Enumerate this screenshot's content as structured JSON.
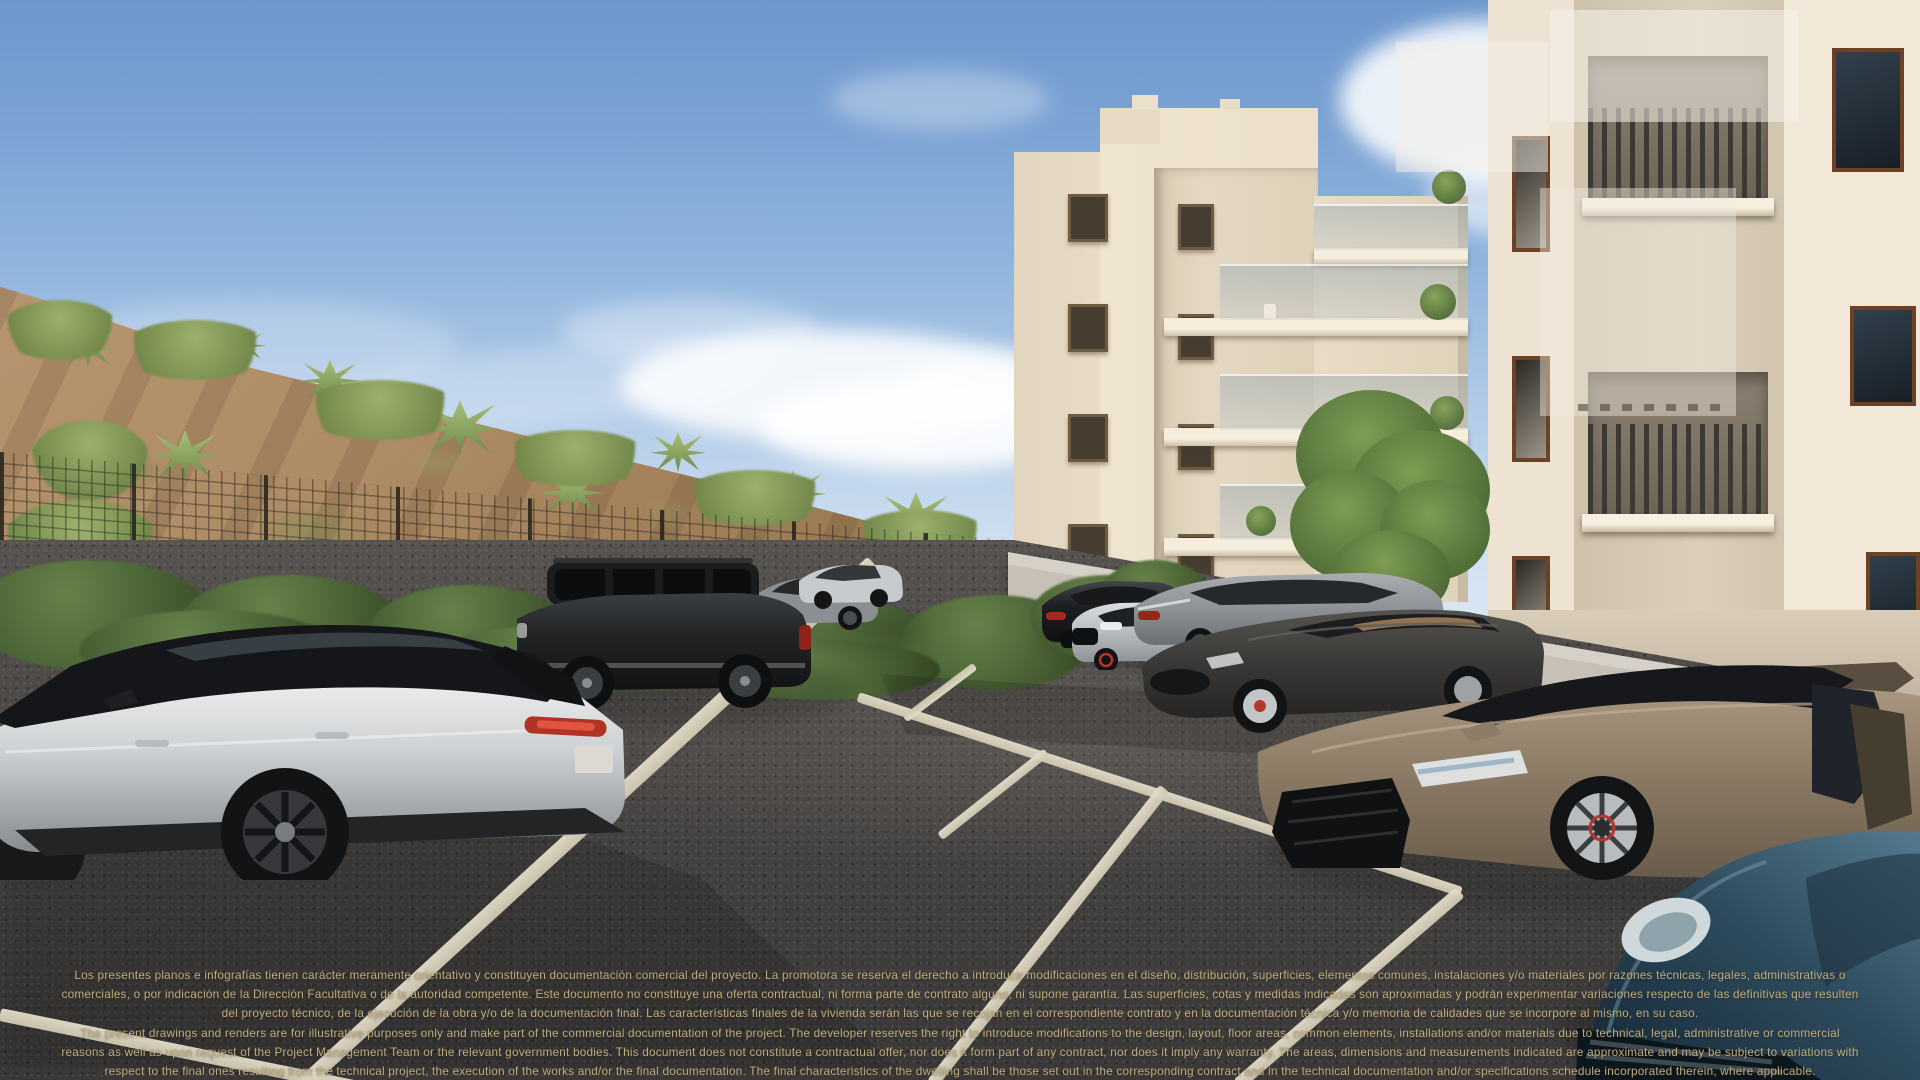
{
  "scene": {
    "type": "architectural-render",
    "description": "Photorealistic real-estate render of an outdoor parking lot with luxury cars in front of two cream apartment buildings, a scrub-covered hillside behind a wire fence, and a blue sky with clouds"
  },
  "disclaimer": {
    "es": "Los presentes planos e infografías tienen carácter meramente orientativo y constituyen documentación comercial del proyecto. La promotora se reserva el derecho a introducir modificaciones en el diseño, distribución, superficies, elementos comunes, instalaciones y/o materiales por razones técnicas, legales, administrativas o comerciales, o por indicación de la Dirección Facultativa o de la autoridad competente. Este documento no constituye una oferta contractual, ni forma parte de contrato alguno, ni supone garantía. Las superficies, cotas y medidas indicadas son aproximadas y podrán experimentar variaciones respecto de las definitivas que resulten del proyecto técnico, de la ejecución de la obra y/o de la documentación final. Las características finales de la vivienda serán las que se recojan en el correspondiente contrato y en la documentación técnica y/o memoria de calidades que se incorpore al mismo, en su caso.",
    "en": "The present drawings and renders are for illustrative purposes only and make part of the commercial documentation of the project. The developer reserves the right to introduce modifications to the design, layout, floor areas, common elements, installations and/or materials due to technical, legal, administrative or commercial reasons as well as upon request of the Project Management Team or the relevant government bodies. This document does not constitute a contractual offer, nor does it form part of any contract, nor does it imply any warranty. The areas, dimensions and measurements indicated are approximate and may be subject to variations with respect to the final ones resulting from the technical project, the execution of the works and/or the final documentation. The final characteristics of the dwelling shall be those set out in the corresponding contract and in the technical documentation and/or specifications schedule incorporated therein, where applicable."
  },
  "cars": [
    {
      "name": "silver-suv-black-roof",
      "color": "#d0d2d4"
    },
    {
      "name": "black-suv",
      "color": "#1d1f20"
    },
    {
      "name": "gray-sedan",
      "color": "#8c8f92"
    },
    {
      "name": "silver-compact-sedan",
      "color": "#c8cbce"
    },
    {
      "name": "black-luxury-sedan",
      "color": "#17181a"
    },
    {
      "name": "silver-sport-sedan",
      "color": "#c2c5c8"
    },
    {
      "name": "gray-gran-turismo",
      "color": "#989b9e"
    },
    {
      "name": "dark-gray-sports-coupe",
      "color": "#3e3c3a"
    },
    {
      "name": "bronze-supercar",
      "color": "#8d7b66"
    },
    {
      "name": "dark-blue-sports-car",
      "color": "#2d4757"
    }
  ],
  "colors": {
    "disclaimer_text": "#bdac7f",
    "sky_top": "#6d97cc",
    "sky_horizon": "#e3edf7",
    "hill_sand": "#ad8b64",
    "shrub_green": "#55703f",
    "building_cream": "#efe4d0",
    "concrete_wall": "#c6c0b6",
    "asphalt": "#4c4947",
    "parking_line": "#e3ddc9"
  }
}
